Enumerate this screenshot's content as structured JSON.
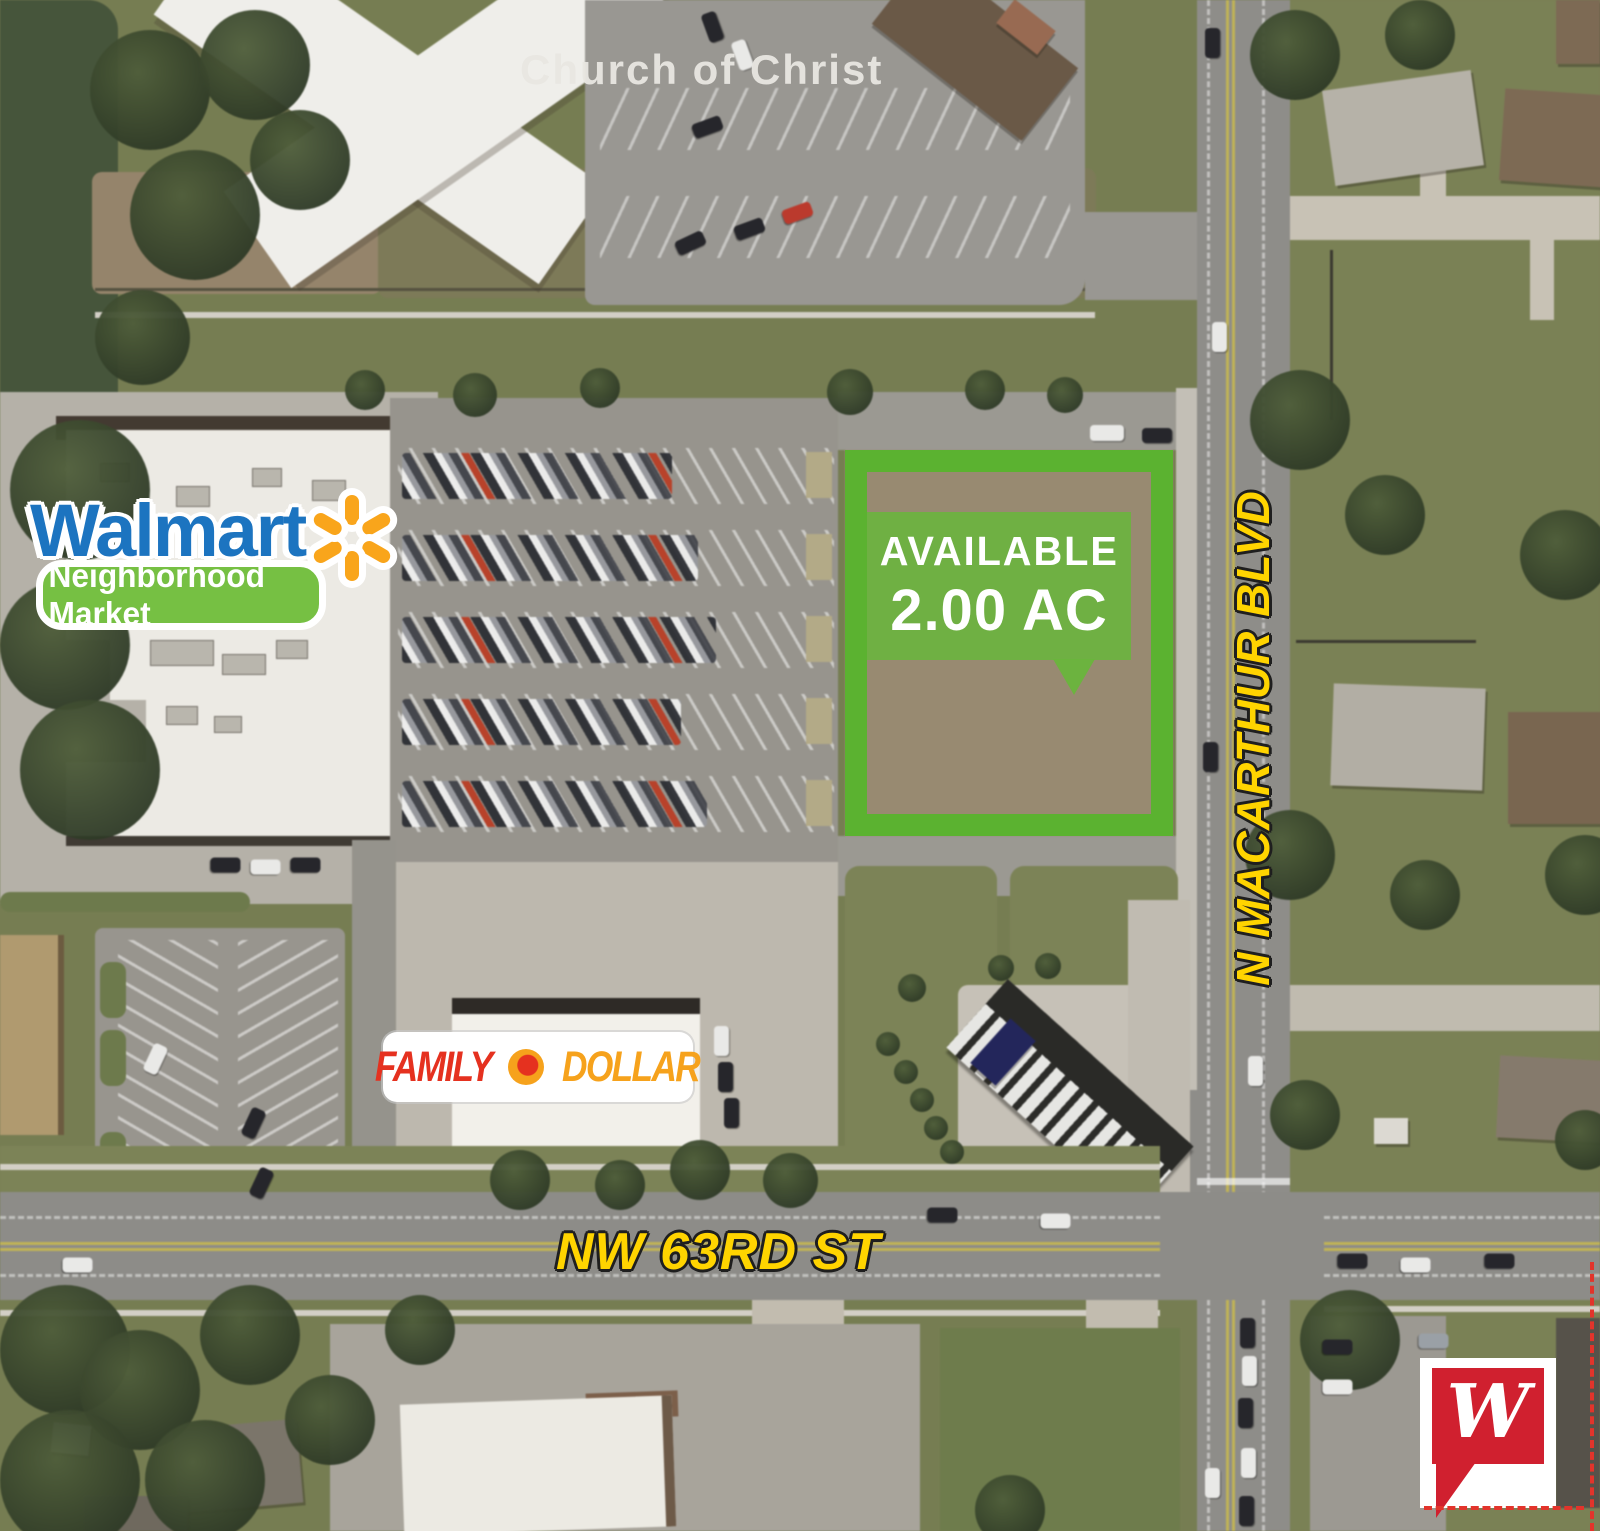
{
  "overlays": {
    "church_label": "Church of Christ",
    "parcel": {
      "status": "AVAILABLE",
      "acreage": "2.00 AC",
      "border_color": "#5bb230",
      "bubble_color": "#69b53c",
      "text_color": "#ffffff"
    },
    "streets": {
      "north_south": "N MACARTHUR BLVD",
      "east_west": "NW 63RD ST",
      "label_color": "#ffd400"
    },
    "brands": {
      "walmart": {
        "wordmark": "Walmart",
        "subtitle": "Neighborhood Market",
        "blue": "#1c74c0",
        "spark_orange": "#f9a51b",
        "pill_green": "#76c043"
      },
      "family_dollar": {
        "word1": "FAMILY",
        "word2": "DOLLAR",
        "red": "#e5311f",
        "orange": "#f6a21c"
      },
      "walgreens": {
        "monogram": "W",
        "red": "#d0202f"
      }
    }
  }
}
